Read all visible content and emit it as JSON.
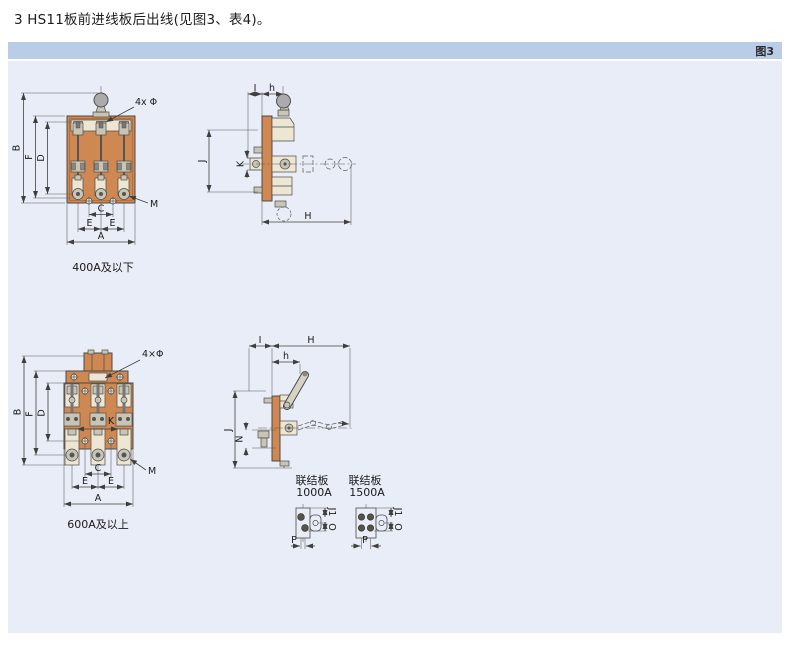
{
  "page": {
    "title": "3 HS11板前进线板后出线(见图3、表4)。",
    "figure_tag": "图3"
  },
  "colors": {
    "panel_bg": "#e9edf7",
    "header_bar": "#b9cde9",
    "board_orange": "#cf8851",
    "insulator_cream": "#ece6d2",
    "metal_gray": "#c9c5b6",
    "line": "#4a4a4a"
  },
  "diagrams": {
    "front400": {
      "caption": "400A及以下",
      "dim_b": "B",
      "dim_f": "F",
      "dim_d": "D",
      "dim_c": "C",
      "dim_e1": "E",
      "dim_e2": "E",
      "dim_a": "A",
      "dim_m": "M",
      "dim_holes": "4x Φ"
    },
    "side400": {
      "dim_i": "I",
      "dim_h": "h",
      "dim_j": "J",
      "dim_k": "K",
      "dim_H": "H"
    },
    "front600": {
      "caption": "600A及以上",
      "dim_b": "B",
      "dim_f": "F",
      "dim_d": "D",
      "dim_k": "K",
      "dim_c": "C",
      "dim_e1": "E",
      "dim_e2": "E",
      "dim_a": "A",
      "dim_m": "M",
      "dim_holes": "4×Φ"
    },
    "side600": {
      "dim_i": "I",
      "dim_H": "H",
      "dim_h": "h",
      "dim_n": "N",
      "dim_j": "J"
    },
    "plate1000": {
      "caption_line1": "联结板",
      "caption_line2": "1000A",
      "dim_j1": "J1",
      "dim_o": "O",
      "dim_p": "P"
    },
    "plate1500": {
      "caption_line1": "联结板",
      "caption_line2": "1500A",
      "dim_j1": "J1",
      "dim_o": "O",
      "dim_p": "P"
    }
  }
}
